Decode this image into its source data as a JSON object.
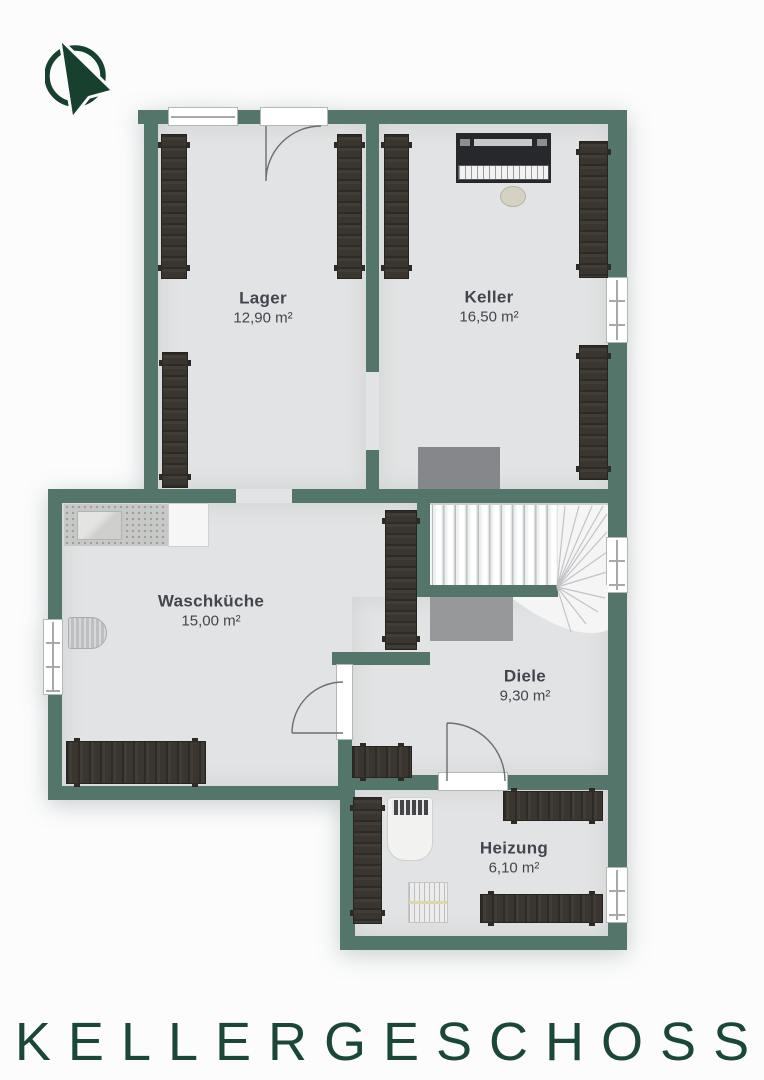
{
  "page": {
    "background": "#fcfcfd"
  },
  "compass": {
    "icon": "north-arrow-icon",
    "color": "#17402f"
  },
  "floorplan": {
    "wall_color": "#53756a",
    "floor_color": "#e2e3e4",
    "wood_color": "#3a362f",
    "rooms": [
      {
        "name": "Lager",
        "area": "12,90 m²"
      },
      {
        "name": "Keller",
        "area": "16,50 m²"
      },
      {
        "name": "Waschküche",
        "area": "15,00 m²"
      },
      {
        "name": "Diele",
        "area": "9,30 m²"
      },
      {
        "name": "Heizung",
        "area": "6,10 m²"
      }
    ],
    "fixtures": [
      "staircase",
      "piano",
      "piano-stool",
      "laundry-counter-with-sink",
      "washing-machine",
      "laundry-basket",
      "storage-shelves",
      "heating-boiler",
      "radiator"
    ]
  },
  "title": {
    "text": "KELLERGESCHOSS",
    "color": "#1b4737"
  }
}
